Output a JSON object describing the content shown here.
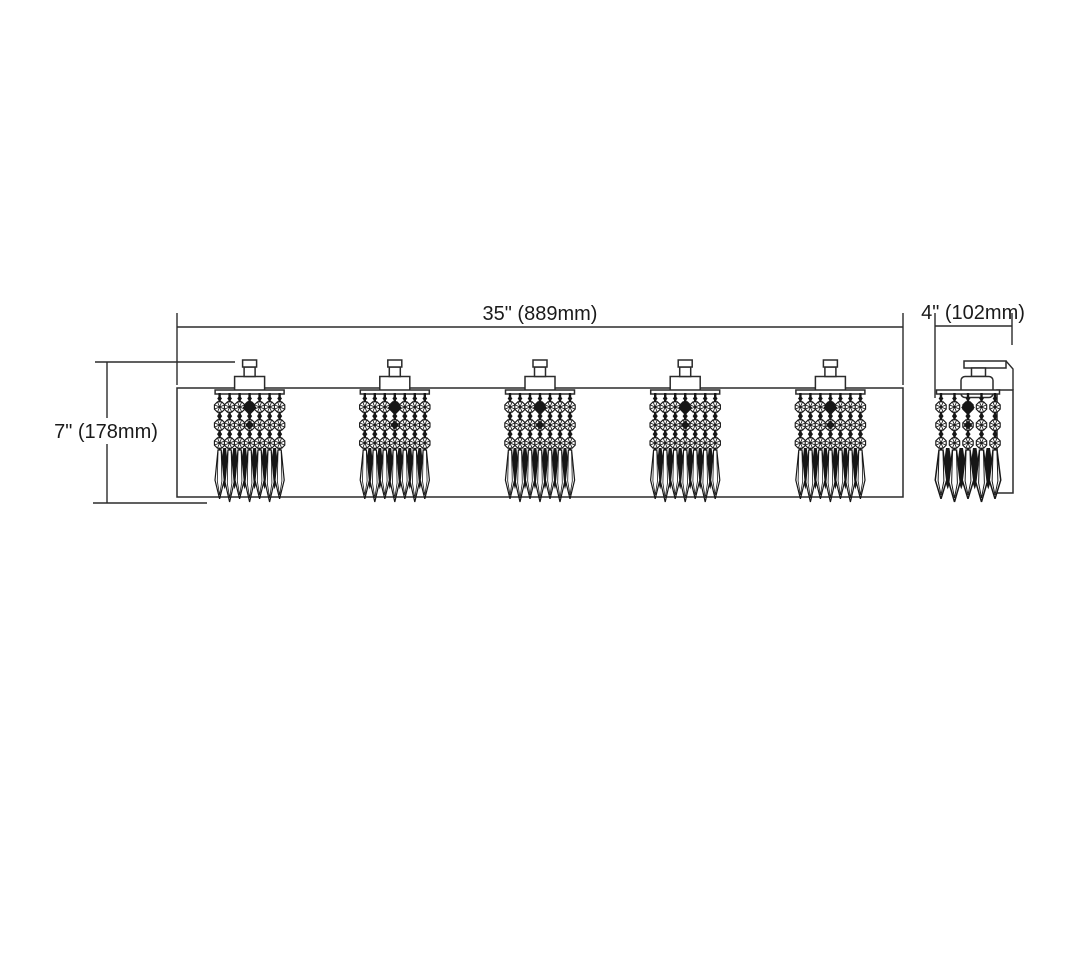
{
  "dimensions": {
    "width": "35\" (889mm)",
    "height": "7\" (178mm)",
    "depth": "4\" (102mm)"
  },
  "fixture": {
    "front_lights": 5,
    "front_strands_per_shade": 7,
    "side_strands": 5,
    "bead_rows_per_strand": 3
  },
  "colors": {
    "line": "#2b2b2b",
    "detail": "#161616",
    "text": "#1a1a1a",
    "background": "#ffffff"
  }
}
